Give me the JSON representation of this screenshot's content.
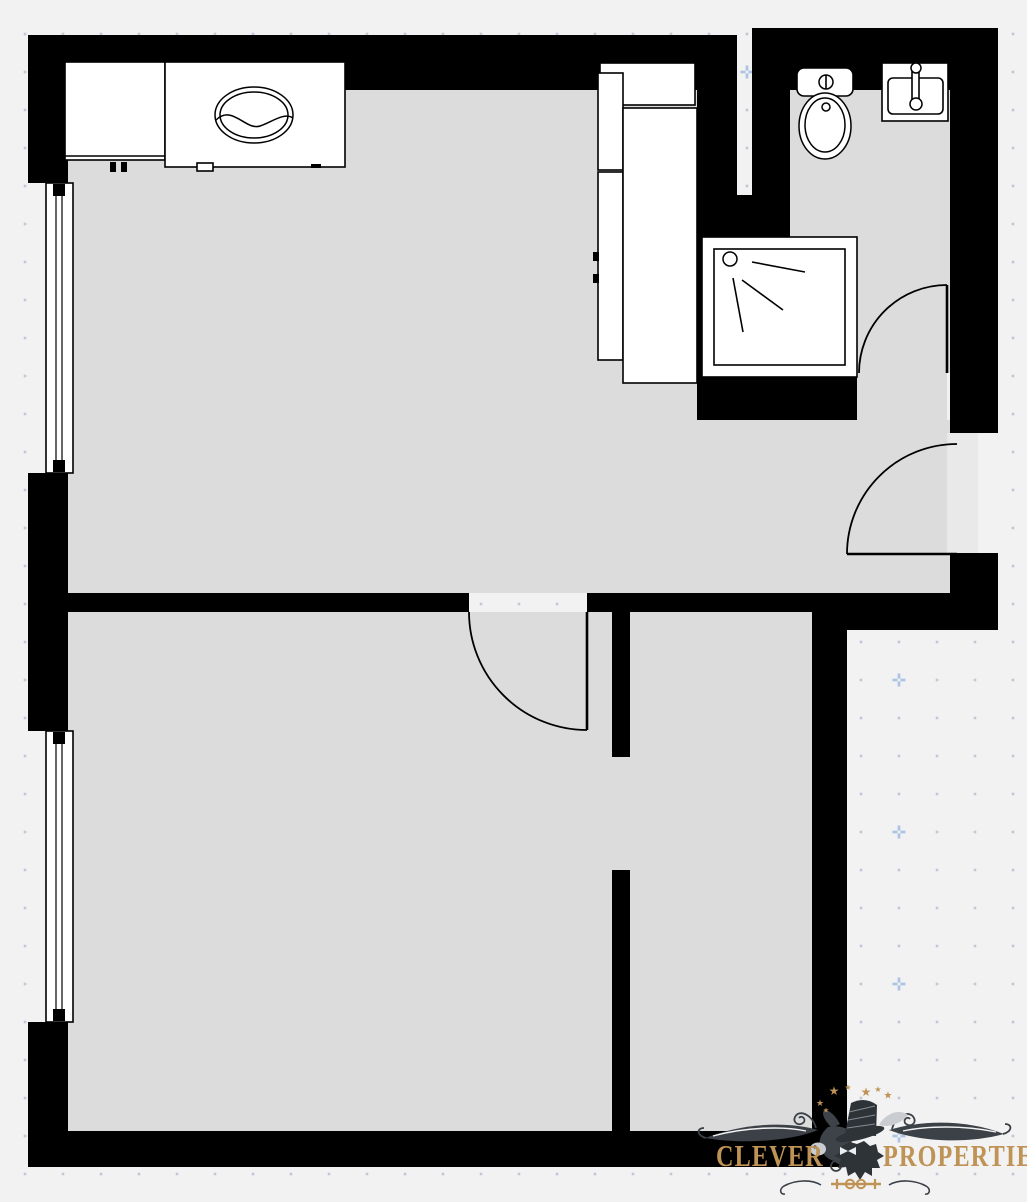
{
  "theme": {
    "bg": "#f2f2f3",
    "floor": "#dcdcdc",
    "threshold": "#e9e9ea",
    "wall": "#000000",
    "fixture_fill": "#ffffff",
    "line": "#000000",
    "dot": "#b4bdca",
    "plus": "#aec4e2",
    "gold": "#bf9255",
    "flourish": "#3c4147",
    "hat": "#2e3338",
    "head": "#3d4349",
    "leaf": "#c9cdd1"
  },
  "grid": {
    "ox": 25,
    "oy": 34,
    "step": 38,
    "plus_kmod": 3,
    "plus_mmod": 1,
    "mod": 4
  },
  "rooms": [
    {
      "name": "living-kitchen",
      "rects": [
        [
          68,
          90,
          629,
          503
        ],
        [
          697,
          420,
          253,
          173
        ]
      ]
    },
    {
      "name": "bathroom",
      "rects": [
        [
          790,
          90,
          160,
          283
        ],
        [
          857,
          373,
          90,
          47
        ]
      ]
    },
    {
      "name": "bedroom",
      "rects": [
        [
          68,
          612,
          544,
          519
        ],
        [
          612,
          757,
          18,
          113
        ]
      ]
    },
    {
      "name": "hallway",
      "rects": [
        [
          630,
          610,
          182,
          521
        ]
      ]
    }
  ],
  "threshold_rect": [
    947,
    433,
    31,
    121
  ],
  "walls": [
    [
      30,
      35,
      707,
      55
    ],
    [
      752,
      28,
      246,
      62
    ],
    [
      28,
      35,
      40,
      148
    ],
    [
      28,
      473,
      40,
      258
    ],
    [
      28,
      1022,
      40,
      145
    ],
    [
      28,
      1131,
      819,
      36
    ],
    [
      697,
      90,
      40,
      330
    ],
    [
      752,
      90,
      38,
      330
    ],
    [
      737,
      195,
      15,
      225
    ],
    [
      790,
      373,
      67,
      47
    ],
    [
      950,
      90,
      48,
      343
    ],
    [
      950,
      553,
      48,
      77
    ],
    [
      812,
      593,
      186,
      37
    ],
    [
      63,
      593,
      406,
      19
    ],
    [
      587,
      593,
      225,
      19
    ],
    [
      612,
      612,
      18,
      145
    ],
    [
      612,
      870,
      18,
      261
    ],
    [
      812,
      610,
      35,
      557
    ]
  ],
  "windows": [
    {
      "name": "window-living",
      "rect": [
        46,
        183,
        27,
        290
      ]
    },
    {
      "name": "window-bedroom",
      "rect": [
        46,
        731,
        27,
        291
      ]
    }
  ],
  "doors": [
    {
      "name": "door-bedroom",
      "leaf": [
        587,
        612,
        587,
        730
      ],
      "arc": {
        "from": [
          469,
          612
        ],
        "to": [
          587,
          730
        ],
        "r": 118,
        "sweep": 0
      }
    },
    {
      "name": "door-bathroom",
      "leaf": [
        947,
        285,
        947,
        373
      ],
      "arc": {
        "from": [
          859,
          373
        ],
        "to": [
          947,
          285
        ],
        "r": 88,
        "sweep": 1
      }
    },
    {
      "name": "door-entry",
      "leaf": [
        847,
        554,
        957,
        554
      ],
      "arc": {
        "from": [
          847,
          554
        ],
        "to": [
          957,
          444
        ],
        "r": 110,
        "sweep": 1
      }
    }
  ],
  "fixtures": [
    {
      "n": "kitchen-counter",
      "t": "rect",
      "d": [
        65,
        62,
        100,
        98
      ]
    },
    {
      "n": "kitchen-counter-edge",
      "t": "line",
      "d": [
        65,
        156,
        165,
        156
      ]
    },
    {
      "n": "kitchen-sink-counter",
      "t": "rect",
      "d": [
        165,
        62,
        180,
        105
      ]
    },
    {
      "n": "kitchen-sink-oval-outer",
      "t": "ellipse",
      "d": [
        254,
        115,
        39,
        28
      ]
    },
    {
      "n": "kitchen-sink-oval-inner",
      "t": "ellipse",
      "d": [
        254,
        115,
        34,
        23
      ]
    },
    {
      "n": "kitchen-sink-waterline",
      "t": "path",
      "d": "M216,120 C232,104 246,131 260,126 C272,122 284,112 293,118"
    },
    {
      "n": "cabinet-handle",
      "t": "blackrect",
      "d": [
        110,
        162,
        6,
        10
      ]
    },
    {
      "n": "cabinet-handle",
      "t": "blackrect",
      "d": [
        121,
        162,
        6,
        10
      ]
    },
    {
      "n": "cabinet-handle",
      "t": "rect",
      "d": [
        197,
        163,
        16,
        8
      ]
    },
    {
      "n": "cabinet-handle",
      "t": "blackrect",
      "d": [
        311,
        164,
        10,
        4
      ]
    },
    {
      "n": "kitchen-tall-unit",
      "t": "rect",
      "d": [
        600,
        63,
        95,
        42
      ]
    },
    {
      "n": "kitchen-tall-unit",
      "t": "rect",
      "d": [
        598,
        73,
        25,
        97
      ]
    },
    {
      "n": "kitchen-tall-unit",
      "t": "rect",
      "d": [
        598,
        172,
        25,
        188
      ]
    },
    {
      "n": "kitchen-tall-unit",
      "t": "rect",
      "d": [
        623,
        108,
        74,
        275
      ]
    },
    {
      "n": "cabinet-handle",
      "t": "blackrect",
      "d": [
        593,
        252,
        6,
        9
      ]
    },
    {
      "n": "cabinet-handle",
      "t": "blackrect",
      "d": [
        593,
        274,
        6,
        9
      ]
    },
    {
      "n": "shower-tray",
      "t": "rect",
      "d": [
        702,
        237,
        155,
        140
      ]
    },
    {
      "n": "shower-tray-inner",
      "t": "rect",
      "d": [
        714,
        249,
        131,
        116
      ]
    },
    {
      "n": "shower-head",
      "t": "circle",
      "d": [
        730,
        259,
        7
      ]
    },
    {
      "n": "shower-spray",
      "t": "line",
      "d": [
        752,
        262,
        805,
        272
      ]
    },
    {
      "n": "shower-spray",
      "t": "line",
      "d": [
        742,
        280,
        783,
        310
      ]
    },
    {
      "n": "shower-spray",
      "t": "line",
      "d": [
        733,
        278,
        743,
        332
      ]
    },
    {
      "n": "toilet-tank",
      "t": "rrect",
      "d": [
        797,
        68,
        56,
        28,
        7
      ]
    },
    {
      "n": "toilet-flush-button",
      "t": "circle",
      "d": [
        826,
        82,
        7
      ]
    },
    {
      "n": "toilet-flush-line",
      "t": "line",
      "d": [
        826,
        75,
        826,
        89
      ]
    },
    {
      "n": "toilet-bowl-outer",
      "t": "ellipse",
      "d": [
        825,
        126,
        26,
        33
      ]
    },
    {
      "n": "toilet-bowl-inner",
      "t": "ellipse",
      "d": [
        825,
        125,
        20,
        27
      ]
    },
    {
      "n": "toilet-bowl-dot",
      "t": "circle",
      "d": [
        826,
        107,
        4
      ]
    },
    {
      "n": "bath-sink",
      "t": "rect",
      "d": [
        882,
        63,
        66,
        58
      ]
    },
    {
      "n": "bath-sink-basin",
      "t": "rrect",
      "d": [
        888,
        78,
        55,
        36,
        5
      ]
    },
    {
      "n": "bath-faucet-bar",
      "t": "rect",
      "d": [
        912,
        68,
        7,
        36
      ]
    },
    {
      "n": "bath-faucet-knob",
      "t": "circle",
      "d": [
        916,
        68,
        5
      ]
    },
    {
      "n": "bath-faucet-knob",
      "t": "circle",
      "d": [
        916,
        104,
        6
      ]
    }
  ],
  "logo": {
    "left_text": "CLEVER",
    "right_text": "PROPERTIES",
    "star_glyph": "★",
    "stars": [
      [
        820,
        1103,
        9
      ],
      [
        834,
        1091,
        12
      ],
      [
        848,
        1087,
        8
      ],
      [
        866,
        1092,
        12
      ],
      [
        878,
        1089,
        8
      ],
      [
        888,
        1095,
        10
      ],
      [
        826,
        1110,
        7
      ]
    ]
  }
}
